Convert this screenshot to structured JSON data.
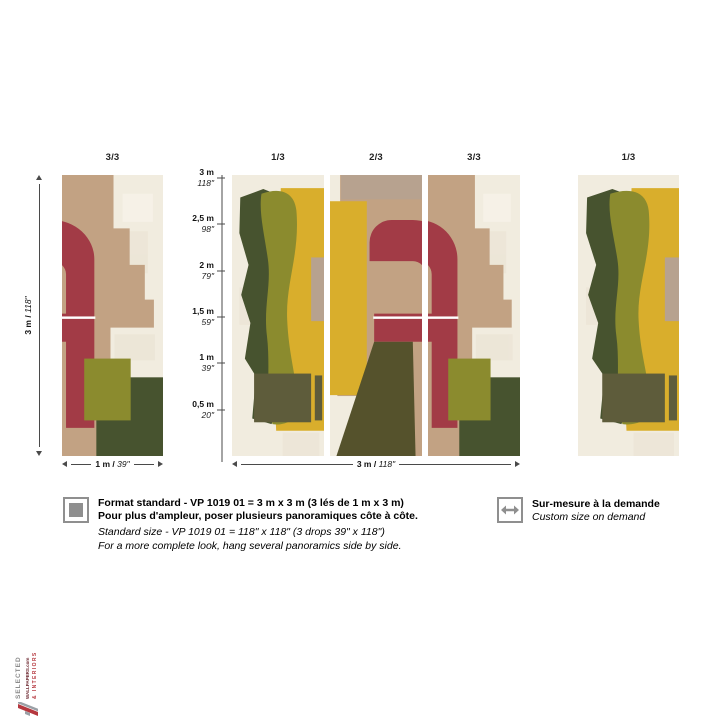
{
  "diagram": {
    "standalone_left": {
      "label": "3/3"
    },
    "strips": [
      {
        "label": "1/3"
      },
      {
        "label": "2/3"
      },
      {
        "label": "3/3"
      }
    ],
    "standalone_right": {
      "label": "1/3"
    },
    "height_dim": {
      "metric": "3 m / ",
      "imperial": "118\""
    },
    "left_width_dim": {
      "metric": "1 m / ",
      "imperial": "39\""
    },
    "middle_width_dim": {
      "metric": "3 m / ",
      "imperial": "118\""
    },
    "scale_ticks": [
      {
        "metric": "3 m",
        "imperial": "118\""
      },
      {
        "metric": "2,5 m",
        "imperial": "98\""
      },
      {
        "metric": "2 m",
        "imperial": "79\""
      },
      {
        "metric": "1,5 m",
        "imperial": "59\""
      },
      {
        "metric": "1 m",
        "imperial": "39\""
      },
      {
        "metric": "0,5 m",
        "imperial": "20\""
      }
    ]
  },
  "info": {
    "standard": {
      "icon": "filled-square-icon",
      "fr_line1": "Format standard - VP 1019 01 = 3 m x 3 m (3 lés de 1 m x 3 m)",
      "fr_line2": "Pour plus d'ampleur, poser plusieurs panoramiques côte à côte.",
      "en_line1": "Standard size - VP 1019 01 = 118\" x 118\" (3 drops 39\" x 118\")",
      "en_line2": "For a more complete look, hang several panoramics side by side."
    },
    "custom": {
      "icon": "horizontal-arrows-icon",
      "fr": "Sur-mesure à la demande",
      "en": "Custom size on demand"
    }
  },
  "logo": {
    "line1": "SELECTED",
    "line2": "WALLPAPERS",
    "line2_suffix": ".com",
    "line3": "& INTERIORS"
  },
  "palette": {
    "cream": "#f1ecdf",
    "tan": "#c2a283",
    "taupe": "#b7a28f",
    "red": "#a23b46",
    "olive": "#8b8b2e",
    "yellow": "#d9ae2c",
    "dark_green": "#47532f",
    "dark_olive": "#5e5c3b",
    "umber": "#55522c",
    "icon_gray": "#8f8f8f",
    "logo_gray": "#8a8a8a",
    "logo_maroon": "#6f2b33",
    "logo_red": "#b5373e"
  }
}
